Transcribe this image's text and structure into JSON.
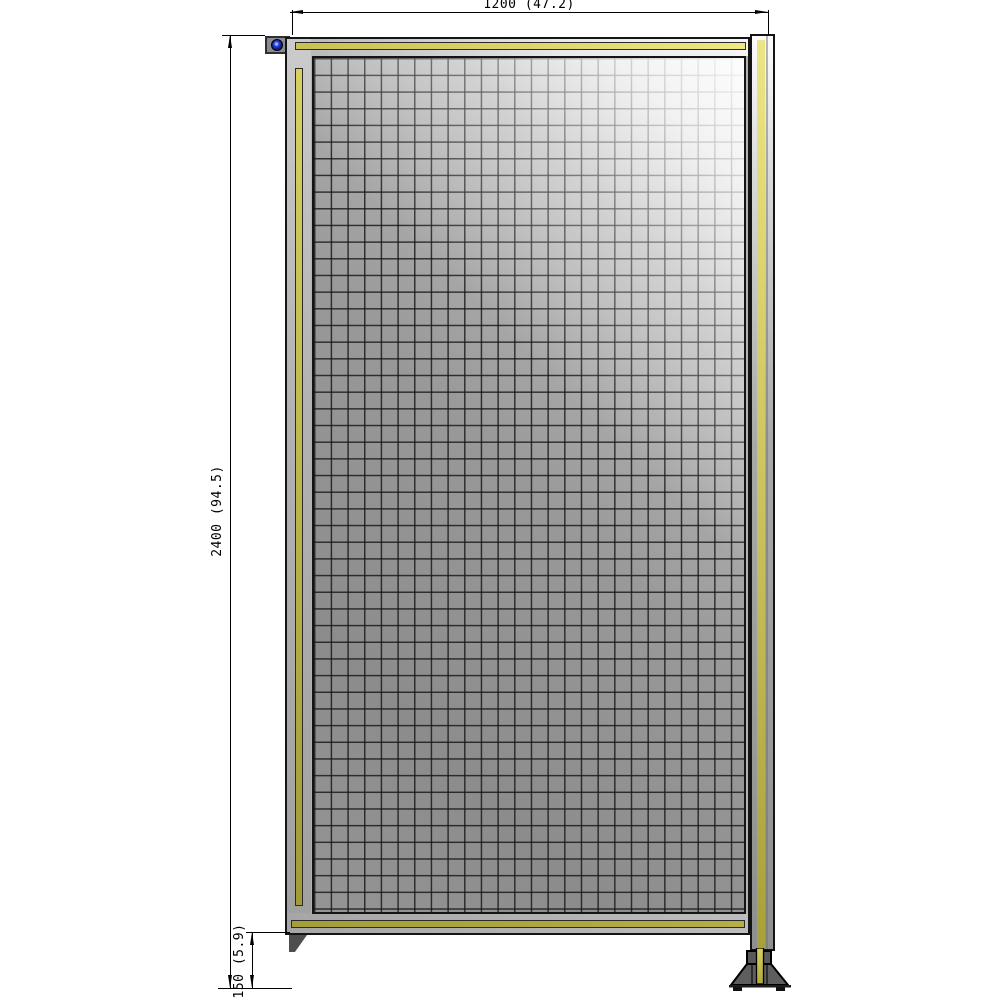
{
  "drawing": {
    "dimensions": {
      "width": "1200 (47.2)",
      "height": "2400 (94.5)",
      "ground_clearance": "150 (5.9)"
    },
    "colors": {
      "accent_yellow": "#d8d05e",
      "accent_olive": "#a59e38",
      "frame_gray": "#b2b2b2",
      "mesh_gray": "#929292",
      "foot_dark_gray": "#585858",
      "bolt_blue": "#2742d8",
      "outline_black": "#141414"
    }
  }
}
